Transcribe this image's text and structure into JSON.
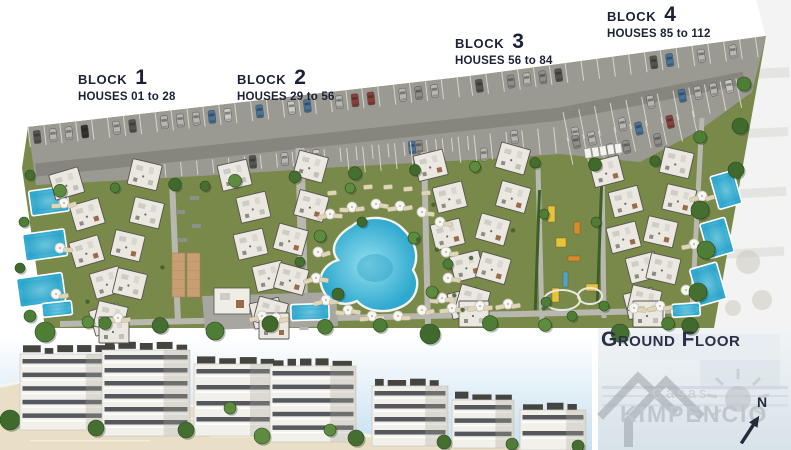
{
  "plan": {
    "blocks": [
      {
        "label": "BLOCK",
        "number": "1",
        "houses": "HOUSES 01 to 28"
      },
      {
        "label": "BLOCK",
        "number": "2",
        "houses": "HOUSES 29 to 56"
      },
      {
        "label": "BLOCK",
        "number": "3",
        "houses": "HOUSES 56 to 84"
      },
      {
        "label": "BLOCK",
        "number": "4",
        "houses": "HOUSES 85 to 112"
      }
    ],
    "floor_label": "Ground Floor"
  },
  "brand": {
    "name_top": "Casas",
    "name_bottom": "KIMPENCIO"
  },
  "compass": {
    "label": "N"
  },
  "colors": {
    "label_text": "#1c2137",
    "ground_floor_text": "#2b3049",
    "grass": "#78894a",
    "parking": "#9b9a92",
    "road": "#86857e",
    "pool_light": "#93dfee",
    "pool_dark": "#2fa9cf",
    "building": "#ebe8e2",
    "sea": "#c6dff0",
    "sand": "#e9dfc6",
    "panel": "#d8e2e9",
    "watermark": "#a6adb2",
    "tree": "#4e7d35",
    "court_tan": "#c89e73",
    "playground_yellow": "#e8c23a"
  }
}
